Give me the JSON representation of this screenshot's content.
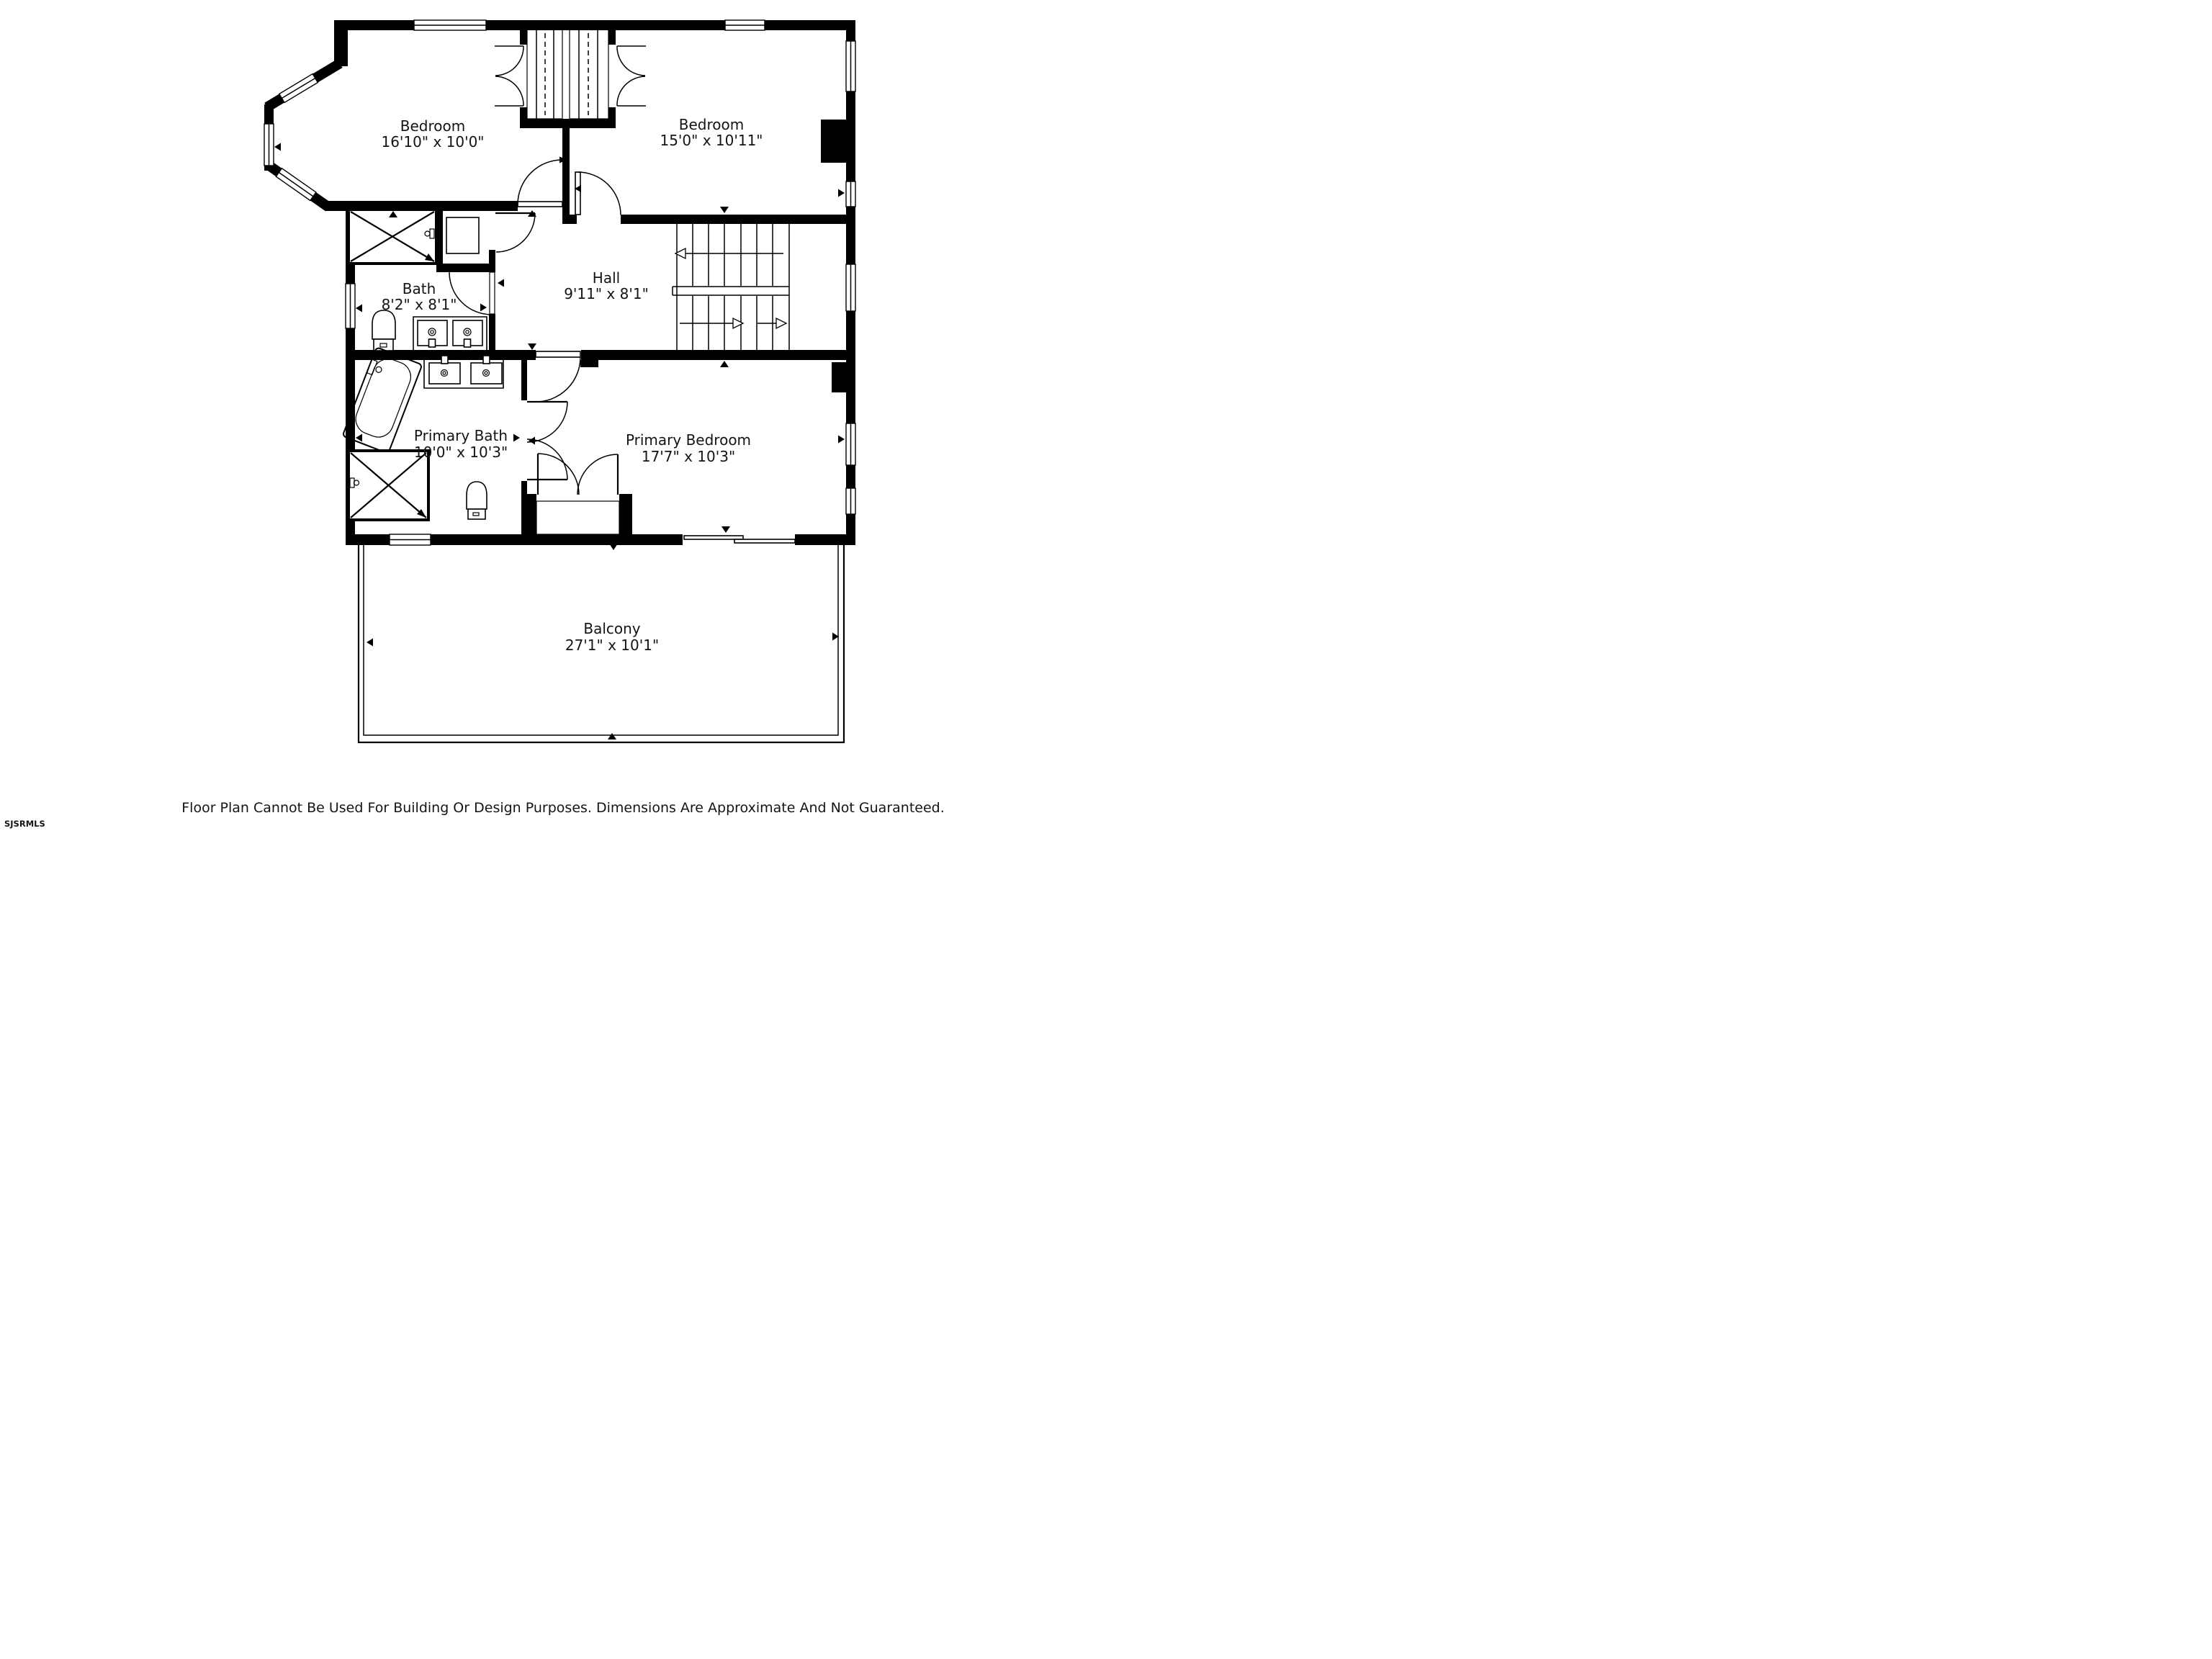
{
  "theme": {
    "wall": "#000000",
    "bg": "#ffffff",
    "ink": "#141414"
  },
  "rooms": [
    {
      "id": "bedroom-1",
      "name": "Bedroom",
      "dims": "16'10\" x 10'0\""
    },
    {
      "id": "bedroom-2",
      "name": "Bedroom",
      "dims": "15'0\" x 10'11\""
    },
    {
      "id": "bath",
      "name": "Bath",
      "dims": "8'2\" x 8'1\""
    },
    {
      "id": "hall",
      "name": "Hall",
      "dims": "9'11\" x 8'1\""
    },
    {
      "id": "primary-bath",
      "name": "Primary Bath",
      "dims": "10'0\" x 10'3\""
    },
    {
      "id": "primary-bedroom",
      "name": "Primary Bedroom",
      "dims": "17'7\" x 10'3\""
    },
    {
      "id": "balcony",
      "name": "Balcony",
      "dims": "27'1\" x 10'1\""
    }
  ],
  "footer": {
    "disclaimer": "Floor Plan Cannot Be Used For Building Or Design Purposes. Dimensions Are Approximate And Not Guaranteed.",
    "watermark": "SJSRMLS"
  }
}
